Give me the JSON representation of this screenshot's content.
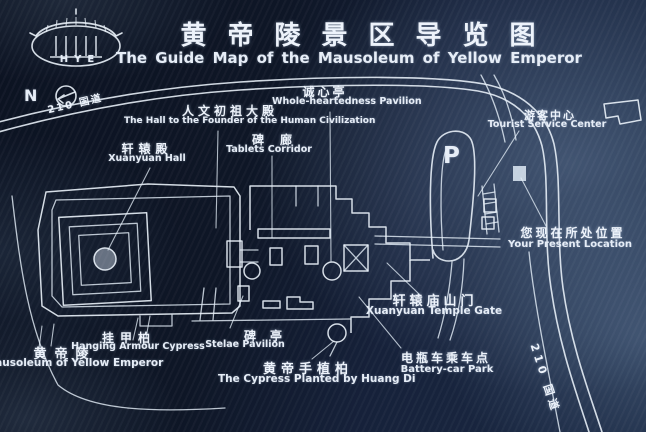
{
  "sign": {
    "logo": {
      "letters": "HYE"
    },
    "title_zh": "黄帝陵景区导览图",
    "title_en": "The Guide Map of the Mausoleum of Yellow Emperor",
    "compass": {
      "label": "N"
    },
    "roads": {
      "top": "210 国道",
      "bottom": "210 国道"
    },
    "parking": "P",
    "labels": [
      {
        "id": "founder-hall",
        "zh": "人文初祖大殿",
        "en": "The Hall to the Founder of the Human Civilization"
      },
      {
        "id": "wholeheartedness-pavilion",
        "zh": "诚心亭",
        "en": "Whole-heartedness Pavilion"
      },
      {
        "id": "tablets-corridor",
        "zh": "碑廊",
        "en": "Tablets Corridor"
      },
      {
        "id": "tourist-service-center",
        "zh": "游客中心",
        "en": "Tourist Service Center"
      },
      {
        "id": "xuanyuan-hall",
        "zh": "轩辕殿",
        "en": "Xuanyuan Hall"
      },
      {
        "id": "present-location",
        "zh": "您现在所处位置",
        "en": "Your Present Location"
      },
      {
        "id": "xuanyuan-temple-gate",
        "zh": "轩辕庙山门",
        "en": "Xuanyuan Temple Gate"
      },
      {
        "id": "hanging-armour-cypress",
        "zh": "挂甲柏",
        "en": "Hanging Armour Cypress"
      },
      {
        "id": "stelae-pavilion",
        "zh": "碑亭",
        "en": "Stelae Pavilion"
      },
      {
        "id": "mausoleum",
        "zh": "黄帝陵",
        "en": "Mausoleum of Yellow Emperor"
      },
      {
        "id": "huangdi-cypress",
        "zh": "黄帝手植柏",
        "en": "The Cypress Planted by Huang Di"
      },
      {
        "id": "battery-car-park",
        "zh": "电瓶车乘车点",
        "en": "Battery-car Park"
      }
    ]
  }
}
